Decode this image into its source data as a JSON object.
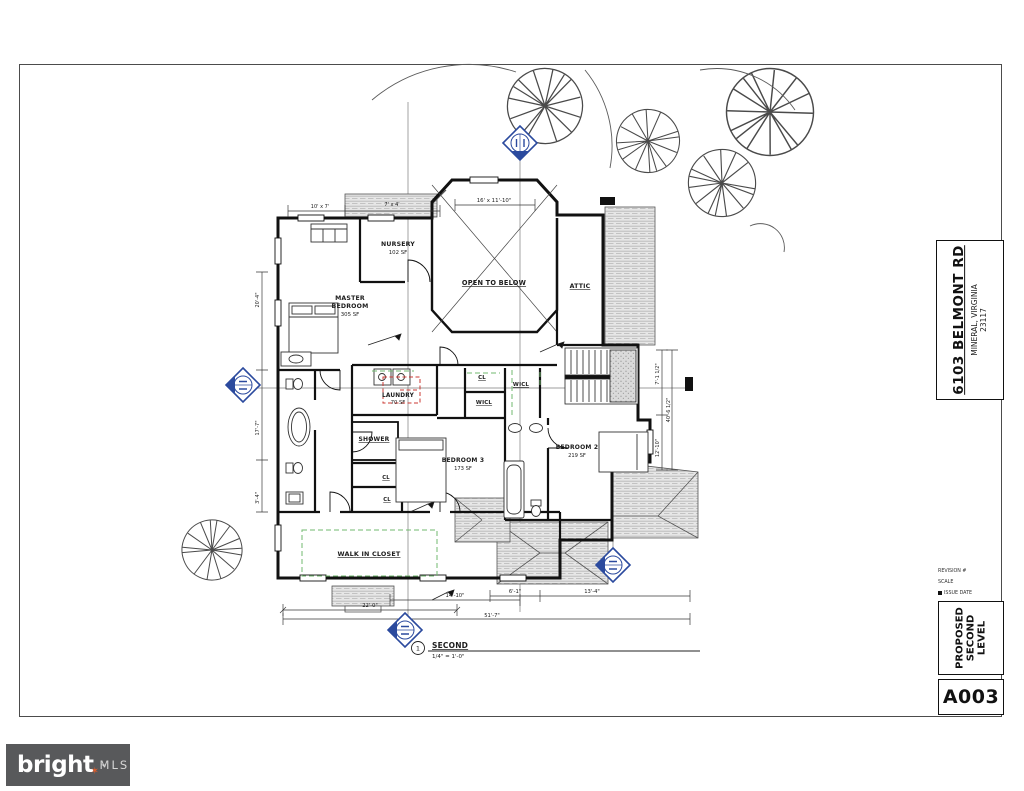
{
  "sheet": {
    "address": "6103 BELMONT RD",
    "city": "MINERAL, VIRGINIA",
    "zip": "23117",
    "revision_label": "REVISION #",
    "scale_label": "SCALE",
    "issue_label": "ISSUE DATE",
    "drawing_title": "PROPOSED SECOND LEVEL",
    "sheet_number": "A003"
  },
  "view_callout": {
    "number": "1",
    "name": "SECOND",
    "scale": "1/4\" = 1'-0\""
  },
  "brand": {
    "word": "bright",
    "suffix": "MLS",
    "tm": "™",
    "star_glyph": "✶",
    "accent_color": "#e05c2a",
    "bar_color": "#58595b"
  },
  "rooms": {
    "nursery": {
      "name": "NURSERY",
      "area": "102 SF"
    },
    "master": {
      "name1": "MASTER",
      "name2": "BEDROOM",
      "area": "305 SF"
    },
    "open_below": {
      "name": "OPEN TO BELOW"
    },
    "attic": {
      "name": "ATTIC"
    },
    "laundry": {
      "name": "LAUNDRY",
      "area": "70 SF"
    },
    "cl_hall": {
      "name": "CL"
    },
    "wicl_right": {
      "name": "WICL"
    },
    "wicl_mid": {
      "name": "WICL"
    },
    "shower": {
      "name": "SHOWER"
    },
    "bedroom3": {
      "name": "BEDROOM 3",
      "area": "173 SF"
    },
    "bedroom2": {
      "name": "BEDROOM 2",
      "area": "219 SF"
    },
    "cl_a": {
      "name": "CL"
    },
    "cl_b": {
      "name": "CL"
    },
    "walkin": {
      "name": "WALK IN CLOSET"
    }
  },
  "dimensions": {
    "bay": "16' x 11'-10\"",
    "top_left": "10' x 7'",
    "top_mid": "7' x 4'",
    "bottom_a": "22'-0\"",
    "bottom_b": "14'-10\"",
    "bottom_c": "6'-1\"",
    "bottom_d": "13'-4\"",
    "overall": "51'-7\"",
    "left_a": "20'-4\"",
    "left_b": "17'-7\"",
    "left_c": "3'-4\"",
    "right_a": "7'-1 1/2\"",
    "right_b": "40'-6 1/2\"",
    "right_c": "12'-10\""
  }
}
